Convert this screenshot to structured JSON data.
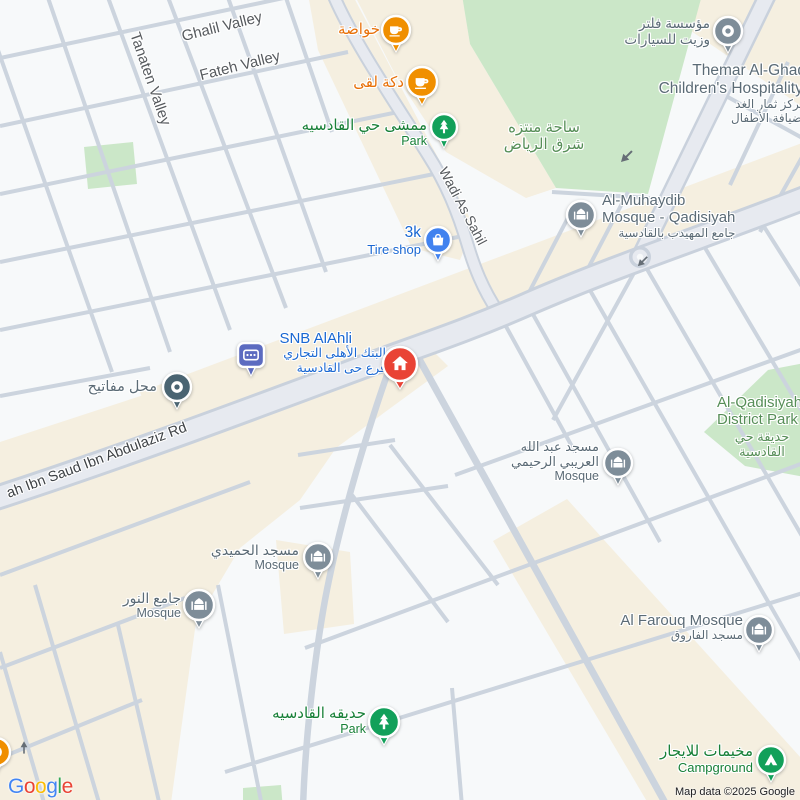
{
  "map": {
    "attribution": "Map data ©2025 Google",
    "logo_letters": [
      {
        "ch": "G",
        "c": "#4285F4"
      },
      {
        "ch": "o",
        "c": "#EA4335"
      },
      {
        "ch": "o",
        "c": "#FBBC05"
      },
      {
        "ch": "g",
        "c": "#4285F4"
      },
      {
        "ch": "l",
        "c": "#34A853"
      },
      {
        "ch": "e",
        "c": "#EA4335"
      }
    ],
    "palette": {
      "roadText": "#565a5e",
      "roadDark": "#3e4246",
      "gray": "#5b6b76",
      "blue": "#1967d2",
      "orange": "#e8710a",
      "green": "#188038",
      "areaGreen": "#568e57",
      "orangeIcon": "#f08f00",
      "greenIcon": "#12a05a",
      "grayIcon": "#7e8d99",
      "blueIcon": "#4182ef",
      "indigoIcon": "#5c6bc0",
      "slateIcon": "#4a6472",
      "redIcon": "#e94335"
    },
    "labels": [
      {
        "name": "road-label-ghalil-valley",
        "x": 222,
        "y": 27,
        "anchor": "middle",
        "rot": -14,
        "interactable": false,
        "lines": [
          {
            "t": "Ghalil Valley",
            "s": 15,
            "c": "roadText"
          }
        ]
      },
      {
        "name": "road-label-fateh-valley",
        "x": 240,
        "y": 66,
        "anchor": "middle",
        "rot": -14,
        "interactable": false,
        "lines": [
          {
            "t": "Fateh Valley",
            "s": 15,
            "c": "roadText"
          }
        ]
      },
      {
        "name": "road-label-tanaten-valley",
        "x": 150,
        "y": 79,
        "anchor": "middle",
        "rot": 71,
        "interactable": false,
        "lines": [
          {
            "t": "Tanaten Valley",
            "s": 15,
            "c": "roadText"
          }
        ]
      },
      {
        "name": "road-label-wadi-as-sahil",
        "x": 463,
        "y": 206,
        "anchor": "middle",
        "rot": 62,
        "interactable": false,
        "lines": [
          {
            "t": "Wadi As Sahil",
            "s": 14,
            "c": "roadText"
          }
        ]
      },
      {
        "name": "road-label-king-abdullah-rd",
        "x": 97,
        "y": 461,
        "anchor": "middle",
        "rot": -20.5,
        "interactable": false,
        "lines": [
          {
            "t": "ah Ibn Saud Ibn Abdulaziz Rd",
            "s": 14.5,
            "c": "roadDark"
          }
        ]
      },
      {
        "name": "poi-label-khawadah",
        "x": 380,
        "y": 21,
        "anchor": "end",
        "interactable": true,
        "lines": [
          {
            "t": "خواضة",
            "s": 15,
            "c": "orange"
          }
        ]
      },
      {
        "name": "poi-label-dakkat-luqa",
        "x": 404,
        "y": 74,
        "anchor": "end",
        "interactable": true,
        "lines": [
          {
            "t": "دكة لقى",
            "s": 15,
            "c": "orange"
          }
        ]
      },
      {
        "name": "poi-label-mamsha-qadisiyah",
        "x": 427,
        "y": 117,
        "anchor": "end",
        "interactable": true,
        "lines": [
          {
            "t": "ممشى حي القادسيه",
            "s": 15,
            "c": "green"
          },
          {
            "t": "Park",
            "s": 12.5,
            "c": "green"
          }
        ]
      },
      {
        "name": "area-label-east-riyadh-plaza",
        "x": 544,
        "y": 119,
        "anchor": "center",
        "interactable": true,
        "lines": [
          {
            "t": "ساحة منتزه",
            "s": 15,
            "c": "areaGreen"
          },
          {
            "t": "شرق الرياض",
            "s": 15,
            "c": "areaGreen"
          }
        ]
      },
      {
        "name": "poi-label-filter-oil-est",
        "x": 710,
        "y": 16,
        "anchor": "end",
        "interactable": true,
        "lines": [
          {
            "t": "مؤسسة فلتر",
            "s": 13.5,
            "c": "gray"
          },
          {
            "t": "وزيت للسيارات",
            "s": 13.5,
            "c": "gray"
          }
        ]
      },
      {
        "name": "poi-label-themar-alghad",
        "x": 806,
        "y": 62,
        "anchor": "end",
        "interactable": true,
        "lines": [
          {
            "t": "Themar Al-Ghad",
            "s": 15.5,
            "c": "gray"
          },
          {
            "t": "Children's Hospitality.",
            "s": 15.5,
            "c": "gray"
          },
          {
            "t": "مركز ثمار الغد",
            "s": 12,
            "c": "gray"
          },
          {
            "t": "لضيافة الأطفال",
            "s": 12,
            "c": "gray"
          }
        ]
      },
      {
        "name": "poi-label-muhaydib-mosque",
        "x": 602,
        "y": 192,
        "anchor": "start",
        "interactable": true,
        "lines": [
          {
            "t": "Al-Muhaydib",
            "s": 15,
            "c": "gray"
          },
          {
            "t": "Mosque - Qadisiyah",
            "s": 15,
            "c": "gray"
          },
          {
            "t": "جامع المهيدب بالقادسية",
            "s": 12,
            "c": "gray"
          }
        ]
      },
      {
        "name": "poi-label-3k-tire-shop",
        "x": 421,
        "y": 224,
        "anchor": "end",
        "interactable": true,
        "lines": [
          {
            "t": "3k",
            "s": 15.5,
            "c": "blue"
          },
          {
            "t": "Tire shop",
            "s": 13,
            "c": "blue"
          }
        ]
      },
      {
        "name": "poi-label-snb-alahli",
        "x": 352,
        "y": 330,
        "anchor": "end",
        "interactable": true,
        "lines": [
          {
            "t": "SNB AlAhli",
            "s": 15,
            "c": "blue"
          }
        ]
      },
      {
        "name": "poi-label-snb-alahli-ar",
        "x": 386,
        "y": 346,
        "anchor": "end",
        "interactable": true,
        "lines": [
          {
            "t": "البنك الأهلى التجاري",
            "s": 12.5,
            "c": "blue"
          },
          {
            "t": "فرع حى القادسية",
            "s": 12.5,
            "c": "blue"
          }
        ]
      },
      {
        "name": "poi-label-key-shop",
        "x": 157,
        "y": 379,
        "anchor": "end",
        "interactable": true,
        "lines": [
          {
            "t": "محل مفاتيح",
            "s": 14.5,
            "c": "gray"
          }
        ]
      },
      {
        "name": "poi-label-abdullah-alaraibi-mosque",
        "x": 599,
        "y": 439,
        "anchor": "end",
        "interactable": true,
        "lines": [
          {
            "t": "مسجد عبد الله",
            "s": 13,
            "c": "gray"
          },
          {
            "t": "العريبي الرحيمي",
            "s": 13,
            "c": "gray"
          },
          {
            "t": "Mosque",
            "s": 12.5,
            "c": "gray"
          }
        ]
      },
      {
        "name": "area-label-qadisiyah-district-park",
        "x": 717,
        "y": 394,
        "anchor": "start",
        "interactable": true,
        "lines": [
          {
            "t": "Al-Qadisiyah",
            "s": 15,
            "c": "areaGreen"
          },
          {
            "t": "District Park",
            "s": 15,
            "c": "areaGreen"
          }
        ]
      },
      {
        "name": "area-label-qadisiyah-district-park-ar",
        "x": 762,
        "y": 429,
        "anchor": "center",
        "interactable": true,
        "lines": [
          {
            "t": "حديقة حي",
            "s": 13,
            "c": "areaGreen"
          },
          {
            "t": "القادسية",
            "s": 13,
            "c": "areaGreen"
          }
        ]
      },
      {
        "name": "poi-label-humaidi-mosque",
        "x": 299,
        "y": 542,
        "anchor": "end",
        "interactable": true,
        "lines": [
          {
            "t": "مسجد الحميدي",
            "s": 14,
            "c": "gray"
          },
          {
            "t": "Mosque",
            "s": 12.5,
            "c": "gray"
          }
        ]
      },
      {
        "name": "poi-label-noor-mosque",
        "x": 181,
        "y": 590,
        "anchor": "end",
        "interactable": true,
        "lines": [
          {
            "t": "جامع النور",
            "s": 14,
            "c": "gray"
          },
          {
            "t": "Mosque",
            "s": 12.5,
            "c": "gray"
          }
        ]
      },
      {
        "name": "poi-label-farouq-mosque",
        "x": 743,
        "y": 612,
        "anchor": "end",
        "interactable": true,
        "lines": [
          {
            "t": "Al Farouq Mosque",
            "s": 15,
            "c": "gray"
          },
          {
            "t": "مسجد الفاروق",
            "s": 12,
            "c": "gray"
          }
        ]
      },
      {
        "name": "poi-label-qadisiyah-park",
        "x": 366,
        "y": 705,
        "anchor": "end",
        "interactable": true,
        "lines": [
          {
            "t": "حديقه القادسيه",
            "s": 15,
            "c": "green"
          },
          {
            "t": "Park",
            "s": 12.5,
            "c": "green"
          }
        ]
      },
      {
        "name": "poi-label-camp-rentals",
        "x": 753,
        "y": 743,
        "anchor": "end",
        "interactable": true,
        "lines": [
          {
            "t": "مخيمات للايجار",
            "s": 15,
            "c": "green"
          },
          {
            "t": "Campground",
            "s": 13,
            "c": "green"
          }
        ]
      }
    ],
    "icons": [
      {
        "name": "cafe-icon",
        "poi": "khawadah",
        "type": "cup",
        "color": "orangeIcon",
        "x": 396,
        "y": 30,
        "r": 14
      },
      {
        "name": "cafe-icon",
        "poi": "dakkat-luqa",
        "type": "cup",
        "color": "orangeIcon",
        "x": 422,
        "y": 82,
        "r": 15
      },
      {
        "name": "park-icon",
        "poi": "mamsha-qadisiyah",
        "type": "tree",
        "color": "greenIcon",
        "x": 444,
        "y": 127,
        "r": 13
      },
      {
        "name": "car-repair-icon",
        "poi": "filter-oil-est",
        "type": "donut",
        "color": "grayIcon",
        "x": 728,
        "y": 31,
        "r": 14
      },
      {
        "name": "mosque-icon",
        "poi": "muhaydib-mosque",
        "type": "mosque",
        "color": "grayIcon",
        "x": 581,
        "y": 215,
        "r": 14
      },
      {
        "name": "shopping-bag-icon",
        "poi": "3k-tire-shop",
        "type": "bag",
        "color": "blueIcon",
        "x": 438,
        "y": 240,
        "r": 13
      },
      {
        "name": "bank-icon",
        "poi": "snb-alahli",
        "type": "bank",
        "color": "indigoIcon",
        "x": 251,
        "y": 355,
        "r": 13
      },
      {
        "name": "key-shop-icon",
        "poi": "key-shop",
        "type": "donut",
        "color": "slateIcon",
        "x": 177,
        "y": 387,
        "r": 14
      },
      {
        "name": "mosque-icon",
        "poi": "abdullah-alaraibi-mosque",
        "type": "mosque",
        "color": "grayIcon",
        "x": 618,
        "y": 463,
        "r": 14
      },
      {
        "name": "mosque-icon",
        "poi": "humaidi-mosque",
        "type": "mosque",
        "color": "grayIcon",
        "x": 318,
        "y": 557,
        "r": 14
      },
      {
        "name": "mosque-icon",
        "poi": "noor-mosque",
        "type": "mosque",
        "color": "grayIcon",
        "x": 199,
        "y": 605,
        "r": 15
      },
      {
        "name": "mosque-icon",
        "poi": "farouq-mosque",
        "type": "mosque",
        "color": "grayIcon",
        "x": 759,
        "y": 630,
        "r": 14
      },
      {
        "name": "park-icon",
        "poi": "qadisiyah-park",
        "type": "tree",
        "color": "greenIcon",
        "x": 384,
        "y": 722,
        "r": 15
      },
      {
        "name": "campground-icon",
        "poi": "camp-rentals",
        "type": "tent",
        "color": "greenIcon",
        "x": 771,
        "y": 760,
        "r": 14
      },
      {
        "name": "poi-edge-icon",
        "poi": "edge-partial",
        "type": "donut",
        "color": "orangeIcon",
        "x": -4,
        "y": 752,
        "r": 14
      },
      {
        "name": "property-marker-icon",
        "poi": "target-property",
        "type": "house",
        "color": "redIcon",
        "x": 400,
        "y": 364,
        "r": 17
      }
    ]
  }
}
